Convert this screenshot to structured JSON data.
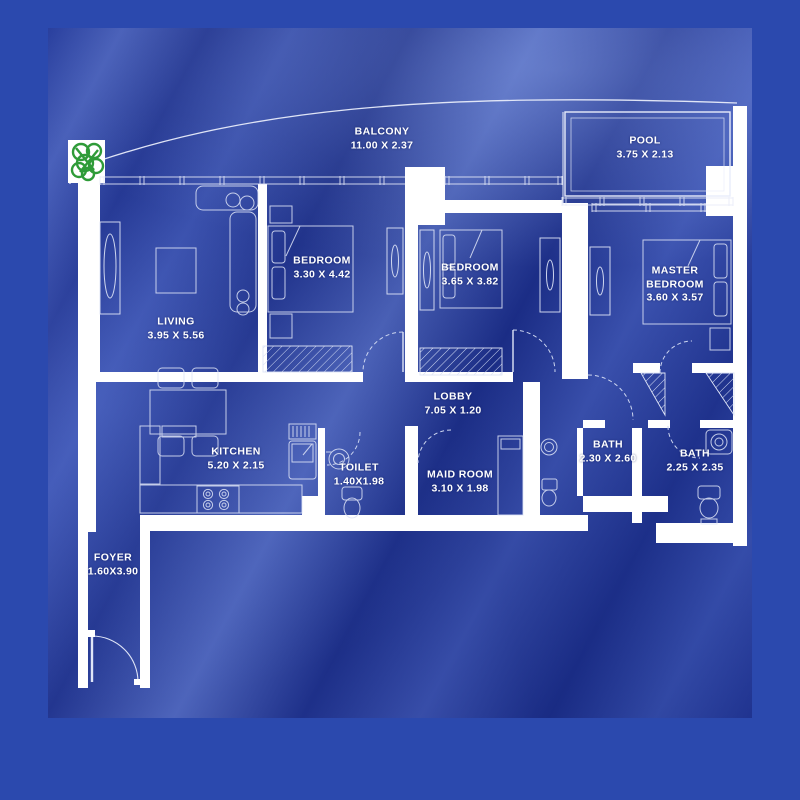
{
  "plan": {
    "rooms": {
      "balcony": {
        "name": "BALCONY",
        "dims": "11.00 X 2.37"
      },
      "pool": {
        "name": "POOL",
        "dims": "3.75 X 2.13"
      },
      "bedroom_1": {
        "name": "BEDROOM",
        "dims": "3.30 X 4.42"
      },
      "bedroom_2": {
        "name": "BEDROOM",
        "dims": "3.65 X 3.82"
      },
      "master_bedroom": {
        "name": "MASTER BEDROOM",
        "dims": "3.60 X 3.57"
      },
      "living": {
        "name": "LIVING",
        "dims": "3.95 X 5.56"
      },
      "kitchen": {
        "name": "KITCHEN",
        "dims": "5.20 X 2.15"
      },
      "lobby": {
        "name": "LOBBY",
        "dims": "7.05 X 1.20"
      },
      "toilet": {
        "name": "TOILET",
        "dims": "1.40X1.98"
      },
      "maid_room": {
        "name": "MAID ROOM",
        "dims": "3.10 X 1.98"
      },
      "bath_1": {
        "name": "BATH",
        "dims": "2.30 X 2.60"
      },
      "bath_2": {
        "name": "BATH",
        "dims": "2.25 X 2.35"
      },
      "foyer": {
        "name": "FOYER",
        "dims": "1.60X3.90"
      }
    },
    "colors": {
      "frame_blue": "#2b49ae",
      "fabric_blue": "#21399f",
      "wall_white": "#ffffff",
      "line_white": "#e8ecfa",
      "plant_green": "#2f9b38"
    },
    "icons": {
      "plant": "plant-icon"
    }
  }
}
